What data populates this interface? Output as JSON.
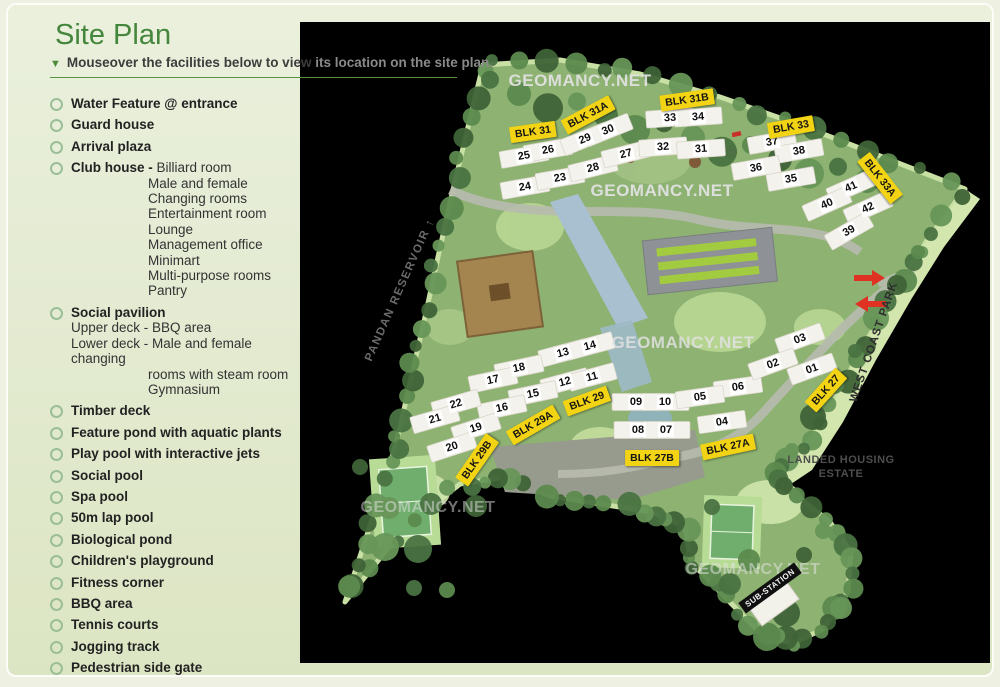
{
  "page": {
    "title": "Site Plan",
    "subtitle": {
      "marker": "▼",
      "front": "Mouseover the facilities below to view ",
      "back": "its location on the site plan."
    }
  },
  "facilities": [
    {
      "label": "Water Feature @ entrance"
    },
    {
      "label": "Guard house"
    },
    {
      "label": "Arrival plaza"
    },
    {
      "label": "Club house -",
      "inline": "Billiard room",
      "details": [
        "Male and female",
        "Changing rooms",
        "Entertainment room",
        "Lounge",
        "Management office",
        "Minimart",
        "Multi-purpose rooms",
        "Pantry"
      ]
    },
    {
      "label": "Social pavilion",
      "sublines": [
        "Upper deck - BBQ area",
        "Lower deck - Male and female changing"
      ],
      "details": [
        "rooms with steam room",
        "Gymnasium"
      ]
    },
    {
      "label": "Timber deck"
    },
    {
      "label": "Feature pond with aquatic plants"
    },
    {
      "label": "Play pool with interactive jets"
    },
    {
      "label": "Social pool"
    },
    {
      "label": "Spa pool"
    },
    {
      "label": "50m lap pool"
    },
    {
      "label": "Biological pond"
    },
    {
      "label": "Children's playground"
    },
    {
      "label": "Fitness corner"
    },
    {
      "label": "BBQ area"
    },
    {
      "label": "Tennis courts"
    },
    {
      "label": "Jogging track"
    },
    {
      "label": "Pedestrian side gate"
    }
  ],
  "map": {
    "watermark_text": "GEOMANCY.NET",
    "watermarks": [
      {
        "x": 280,
        "y": 59,
        "opacity": 0.92,
        "size": 17
      },
      {
        "x": 362,
        "y": 169,
        "opacity": 0.95,
        "size": 17
      },
      {
        "x": 383,
        "y": 321,
        "opacity": 0.85,
        "size": 17
      },
      {
        "x": 128,
        "y": 486,
        "opacity": 0.5,
        "size": 16
      },
      {
        "x": 453,
        "y": 548,
        "opacity": 0.55,
        "size": 16
      }
    ],
    "block_labels": [
      {
        "text": "BLK 31",
        "x": 233,
        "y": 110,
        "rot": -8
      },
      {
        "text": "BLK 31A",
        "x": 288,
        "y": 93,
        "rot": -28
      },
      {
        "text": "BLK 31B",
        "x": 387,
        "y": 78,
        "rot": -8
      },
      {
        "text": "BLK 33",
        "x": 491,
        "y": 105,
        "rot": -10
      },
      {
        "text": "BLK 33A",
        "x": 580,
        "y": 156,
        "rot": 52
      },
      {
        "text": "BLK 27",
        "x": 526,
        "y": 368,
        "rot": -48
      },
      {
        "text": "BLK 29",
        "x": 287,
        "y": 379,
        "rot": -20
      },
      {
        "text": "BLK 29A",
        "x": 233,
        "y": 403,
        "rot": -30
      },
      {
        "text": "BLK 29B",
        "x": 177,
        "y": 438,
        "rot": -55
      },
      {
        "text": "BLK 27A",
        "x": 428,
        "y": 425,
        "rot": -12
      },
      {
        "text": "BLK 27B",
        "x": 352,
        "y": 436,
        "rot": 0
      }
    ],
    "unit_numbers": [
      {
        "n": "25",
        "x": 224,
        "y": 134,
        "rot": -10
      },
      {
        "n": "26",
        "x": 248,
        "y": 128,
        "rot": -10
      },
      {
        "n": "24",
        "x": 225,
        "y": 165,
        "rot": -10
      },
      {
        "n": "23",
        "x": 260,
        "y": 156,
        "rot": -10
      },
      {
        "n": "29",
        "x": 285,
        "y": 117,
        "rot": -22
      },
      {
        "n": "30",
        "x": 308,
        "y": 108,
        "rot": -22
      },
      {
        "n": "28",
        "x": 293,
        "y": 146,
        "rot": -14
      },
      {
        "n": "27",
        "x": 326,
        "y": 132,
        "rot": -14
      },
      {
        "n": "33",
        "x": 370,
        "y": 96,
        "rot": -4
      },
      {
        "n": "34",
        "x": 398,
        "y": 95,
        "rot": -4
      },
      {
        "n": "32",
        "x": 363,
        "y": 125,
        "rot": -4
      },
      {
        "n": "31",
        "x": 401,
        "y": 127,
        "rot": -4
      },
      {
        "n": "37",
        "x": 472,
        "y": 120,
        "rot": -10
      },
      {
        "n": "38",
        "x": 499,
        "y": 129,
        "rot": -10
      },
      {
        "n": "36",
        "x": 456,
        "y": 146,
        "rot": -10
      },
      {
        "n": "35",
        "x": 491,
        "y": 157,
        "rot": -10
      },
      {
        "n": "41",
        "x": 551,
        "y": 165,
        "rot": -24
      },
      {
        "n": "40",
        "x": 527,
        "y": 182,
        "rot": -24
      },
      {
        "n": "42",
        "x": 568,
        "y": 186,
        "rot": -24
      },
      {
        "n": "39",
        "x": 549,
        "y": 209,
        "rot": -30
      },
      {
        "n": "13",
        "x": 263,
        "y": 331,
        "rot": -15
      },
      {
        "n": "14",
        "x": 290,
        "y": 324,
        "rot": -15
      },
      {
        "n": "18",
        "x": 219,
        "y": 346,
        "rot": -12
      },
      {
        "n": "17",
        "x": 193,
        "y": 358,
        "rot": -12
      },
      {
        "n": "12",
        "x": 265,
        "y": 360,
        "rot": -15
      },
      {
        "n": "11",
        "x": 292,
        "y": 355,
        "rot": -15
      },
      {
        "n": "15",
        "x": 233,
        "y": 372,
        "rot": -12
      },
      {
        "n": "16",
        "x": 202,
        "y": 386,
        "rot": -12
      },
      {
        "n": "22",
        "x": 156,
        "y": 382,
        "rot": -16
      },
      {
        "n": "21",
        "x": 135,
        "y": 397,
        "rot": -16
      },
      {
        "n": "19",
        "x": 176,
        "y": 406,
        "rot": -18
      },
      {
        "n": "20",
        "x": 152,
        "y": 425,
        "rot": -18
      },
      {
        "n": "09",
        "x": 336,
        "y": 380,
        "rot": 0
      },
      {
        "n": "10",
        "x": 365,
        "y": 380,
        "rot": 0
      },
      {
        "n": "08",
        "x": 338,
        "y": 408,
        "rot": 0
      },
      {
        "n": "07",
        "x": 366,
        "y": 408,
        "rot": 0
      },
      {
        "n": "06",
        "x": 438,
        "y": 365,
        "rot": -8
      },
      {
        "n": "05",
        "x": 400,
        "y": 375,
        "rot": -8
      },
      {
        "n": "04",
        "x": 422,
        "y": 400,
        "rot": -8
      },
      {
        "n": "03",
        "x": 500,
        "y": 317,
        "rot": -20
      },
      {
        "n": "02",
        "x": 473,
        "y": 342,
        "rot": -20
      },
      {
        "n": "01",
        "x": 512,
        "y": 347,
        "rot": -20
      }
    ],
    "area_labels": {
      "pandan": "PANDAN RESERVOIR ↑",
      "west_coast": "WEST COAST PARK",
      "landed_line1": "LANDED HOUSING",
      "landed_line2": "ESTATE",
      "substation": "SUB-STATION"
    }
  },
  "colors": {
    "title_green": "#44863c",
    "rule_green": "#57923f",
    "bullet_ring": "#9abf96",
    "block_label_bg": "#f3d414",
    "arrow_red": "#e03222",
    "map_bg": "#000000"
  }
}
